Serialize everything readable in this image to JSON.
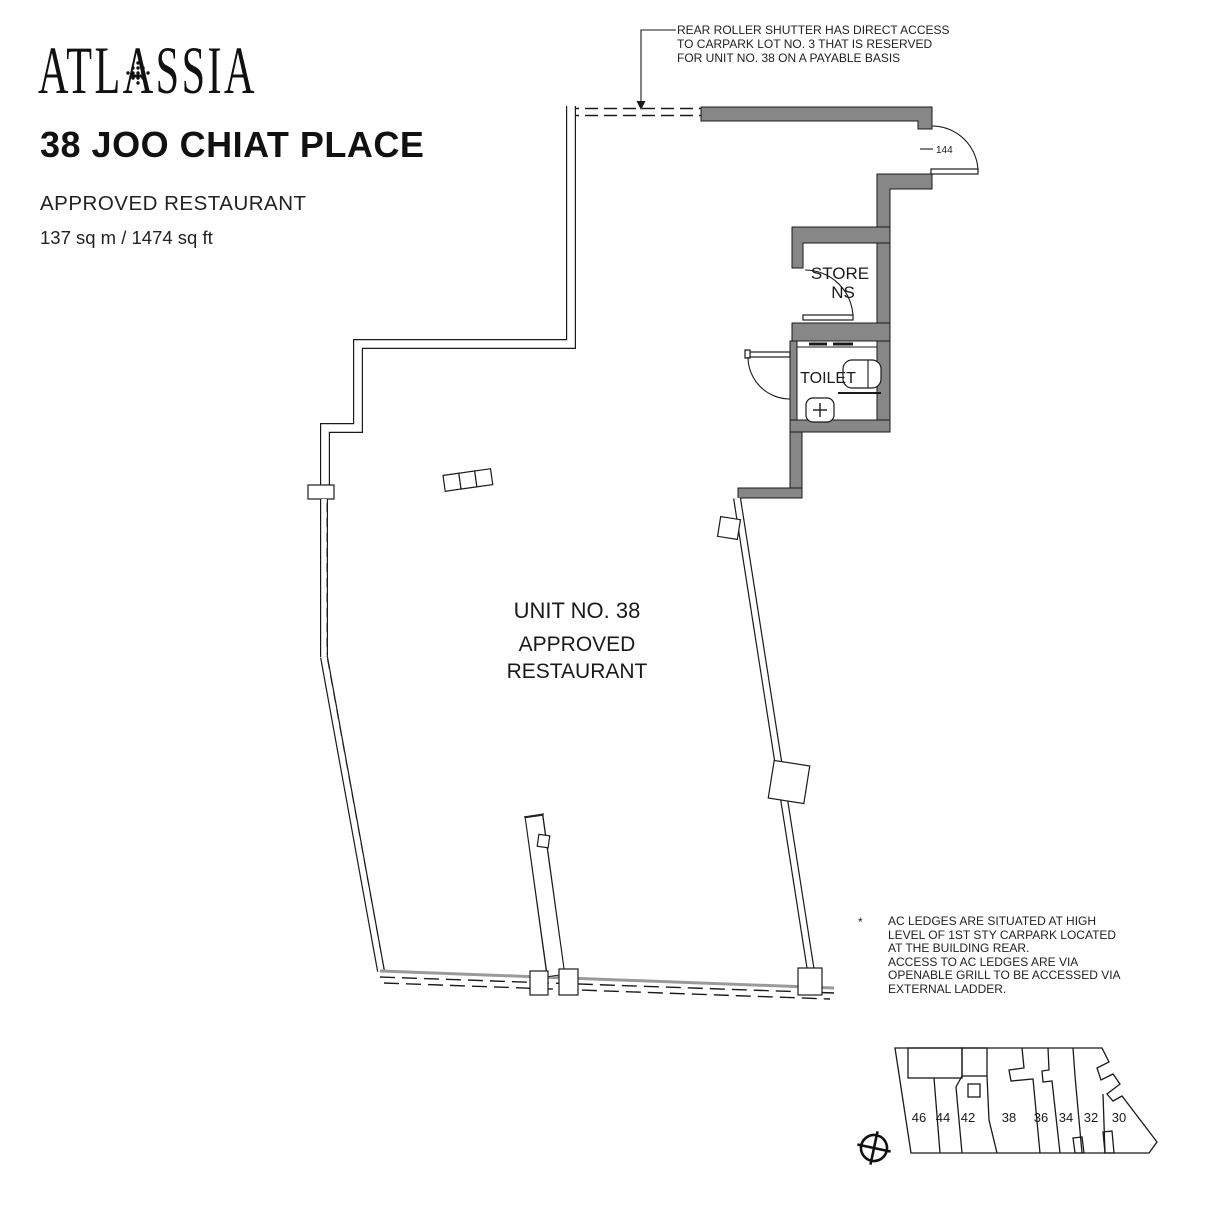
{
  "header": {
    "logo": "ATLASSIA",
    "title": "38 JOO CHIAT PLACE",
    "subtitle": "APPROVED RESTAURANT",
    "area": "137 sq m / 1474 sq ft"
  },
  "callout": {
    "line1": "REAR ROLLER SHUTTER HAS DIRECT ACCESS",
    "line2": "TO CARPARK LOT NO. 3 THAT IS RESERVED",
    "line3": "FOR UNIT NO. 38 ON A PAYABLE BASIS"
  },
  "plan": {
    "unit_line1": "UNIT NO. 38",
    "unit_line2": "APPROVED",
    "unit_line3": "RESTAURANT",
    "store_line1": "STORE",
    "store_line2": "NS",
    "toilet_label": "TOILET",
    "door_label": "144"
  },
  "footnote": {
    "marker": "*",
    "line1": "AC LEDGES ARE SITUATED AT HIGH",
    "line2": "LEVEL OF 1ST STY CARPARK LOCATED",
    "line3": "AT THE BUILDING REAR.",
    "line4": "ACCESS TO AC LEDGES ARE VIA",
    "line5": "OPENABLE GRILL TO BE ACCESSED VIA",
    "line6": "EXTERNAL LADDER."
  },
  "key_plan": {
    "units": [
      "46",
      "44",
      "42",
      "38",
      "36",
      "34",
      "32",
      "30"
    ]
  },
  "colors": {
    "wall_gray": "#878787",
    "line": "#1a1a1a"
  }
}
